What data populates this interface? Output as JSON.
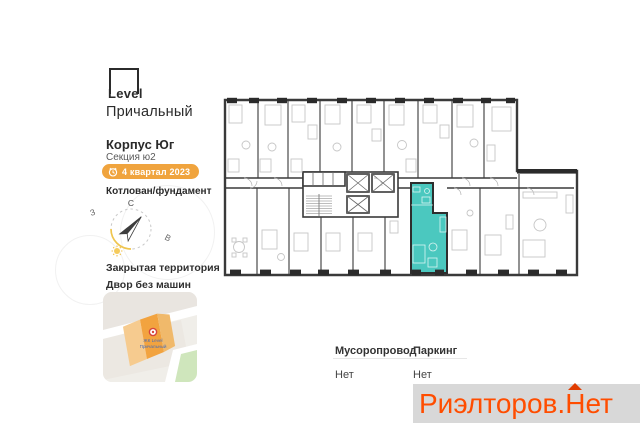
{
  "sidebar": {
    "logo": {
      "brand": "Level",
      "project": "Причальный"
    },
    "building": "Корпус Юг",
    "section": "Секция ю2",
    "badge": {
      "label": "4 квартал 2023",
      "color": "#F0A43E"
    },
    "stage": "Котлован/фундамент",
    "compass": {
      "north": "С",
      "west": "З",
      "east": "В"
    },
    "features": [
      "Закрытая территория",
      "Двор без машин"
    ],
    "map": {
      "label_line1": "ЖК Level",
      "label_line2": "Причальный"
    }
  },
  "floorplan": {
    "highlight_color": "#4BC8BF",
    "highlighted_unit": "studio apartment"
  },
  "details": {
    "items": [
      {
        "label": "Мусоропровод",
        "value": "Нет"
      },
      {
        "label": "Паркинг",
        "value": "Нет"
      }
    ]
  },
  "watermark": {
    "part1": "Риэлторов.",
    "part2": "Н",
    "part3": "ет",
    "color": "#FF4D00"
  }
}
